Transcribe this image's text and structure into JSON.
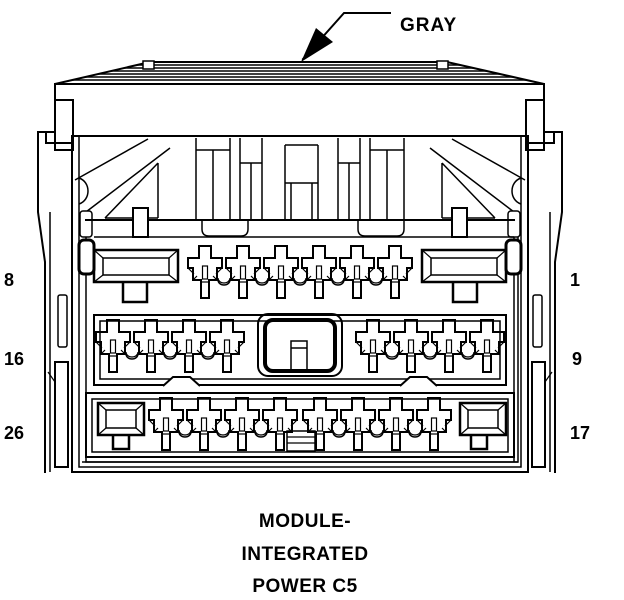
{
  "figure": {
    "type": "connector-pinout-diagram",
    "callout": {
      "label": "GRAY"
    },
    "pin_labels": {
      "row1_left": "8",
      "row1_right": "1",
      "row2_left": "16",
      "row2_right": "9",
      "row3_left": "26",
      "row3_right": "17"
    },
    "caption": {
      "line1": "MODULE-",
      "line2": "INTEGRATED",
      "line3": "POWER C5"
    },
    "colors": {
      "line": "#000000",
      "background": "#ffffff"
    }
  }
}
